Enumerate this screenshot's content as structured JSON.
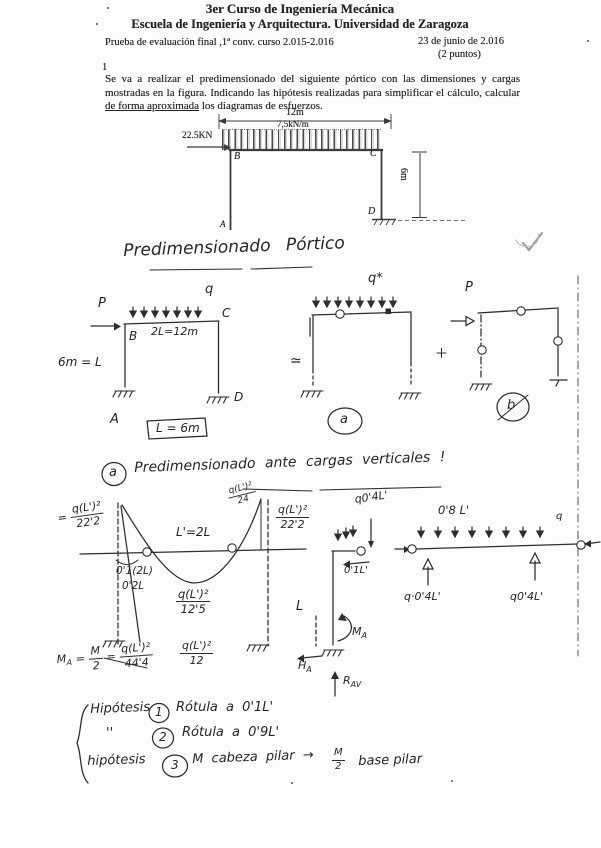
{
  "header": {
    "course": "3er Curso de Ingeniería Mecánica",
    "school": "Escuela de Ingeniería y Arquitectura. Universidad de Zaragoza",
    "exam": "Prueba de evaluación final ,1ª conv. curso 2.015-2.016",
    "date": "23 de junio de 2.016",
    "points": "(2 puntos)",
    "number": "1"
  },
  "problem": {
    "before": "Se va a realizar el predimensionado del siguiente pórtico con las dimensiones y cargas mostradas en la figura. Indicando las hipótesis realizadas para simplificar el cálculo, calcular ",
    "underlined": "de forma aproximada",
    "after": " los diagramas de esfuerzos."
  },
  "figure": {
    "span": "12m",
    "load": "7,5kN/m",
    "hload": "22.5KN",
    "height": "6m",
    "a": "A",
    "b": "B",
    "c": "C",
    "d": "D"
  },
  "hand": {
    "title": "Predimensionado  Pórtico",
    "s1": {
      "p": "P",
      "q": "q",
      "span": "2L=12m",
      "b": "B",
      "c": "C",
      "a": "A",
      "d": "D",
      "height": "6m = L",
      "boxed": "L = 6m"
    },
    "approx": "≃",
    "s2": {
      "q": "q*",
      "tag": "a"
    },
    "s3": {
      "p": "P",
      "tag": "b"
    },
    "section_a": {
      "tag": "a",
      "title": "Predimensionado ante cargas verticales !"
    },
    "md": {
      "eq": "=",
      "fl_n": "q(L')²",
      "fl_d": "22'2",
      "span": "L'=2L",
      "peak_n": "q(L')²",
      "peak_d": "24",
      "fr_n": "q(L')²",
      "fr_d": "22'2",
      "off1": "0'1(2L)",
      "off2": "0'2L",
      "mid_n": "q(L')²",
      "mid_d": "12'5",
      "mid2_n": "q(L')²",
      "mid2_d": "12",
      "ma_sym": "M",
      "ma_sub": "A",
      "ma_eq1": "=",
      "ma_n1": "M",
      "ma_d1": "2",
      "ma_eq2": "=",
      "ma_n2": "q(L')²",
      "ma_d2": "44'4"
    },
    "fbd": {
      "corner_load": "q0'4L'",
      "span": "0'8 L'",
      "q": "q",
      "stub": "0'1L'",
      "r_left": "q·0'4L'",
      "r_right": "q0'4L'",
      "col": "L",
      "m_sym": "M",
      "m_sub": "A",
      "h_sym": "H",
      "h_sub": "A",
      "v_sym": "R",
      "v_sub": "AV"
    },
    "hyp": {
      "w1": "Hipótesis",
      "n1": "1",
      "t1": "Rótula a 0'1L'",
      "w2": "''",
      "n2": "2",
      "t2": "Rótula a 0'9L'",
      "w3": "hipótesis",
      "n3": "3",
      "t3a": "M cabeza pilar →",
      "t3n": "M",
      "t3d": "2",
      "t3b": "base pilar"
    },
    "check": "✓"
  }
}
